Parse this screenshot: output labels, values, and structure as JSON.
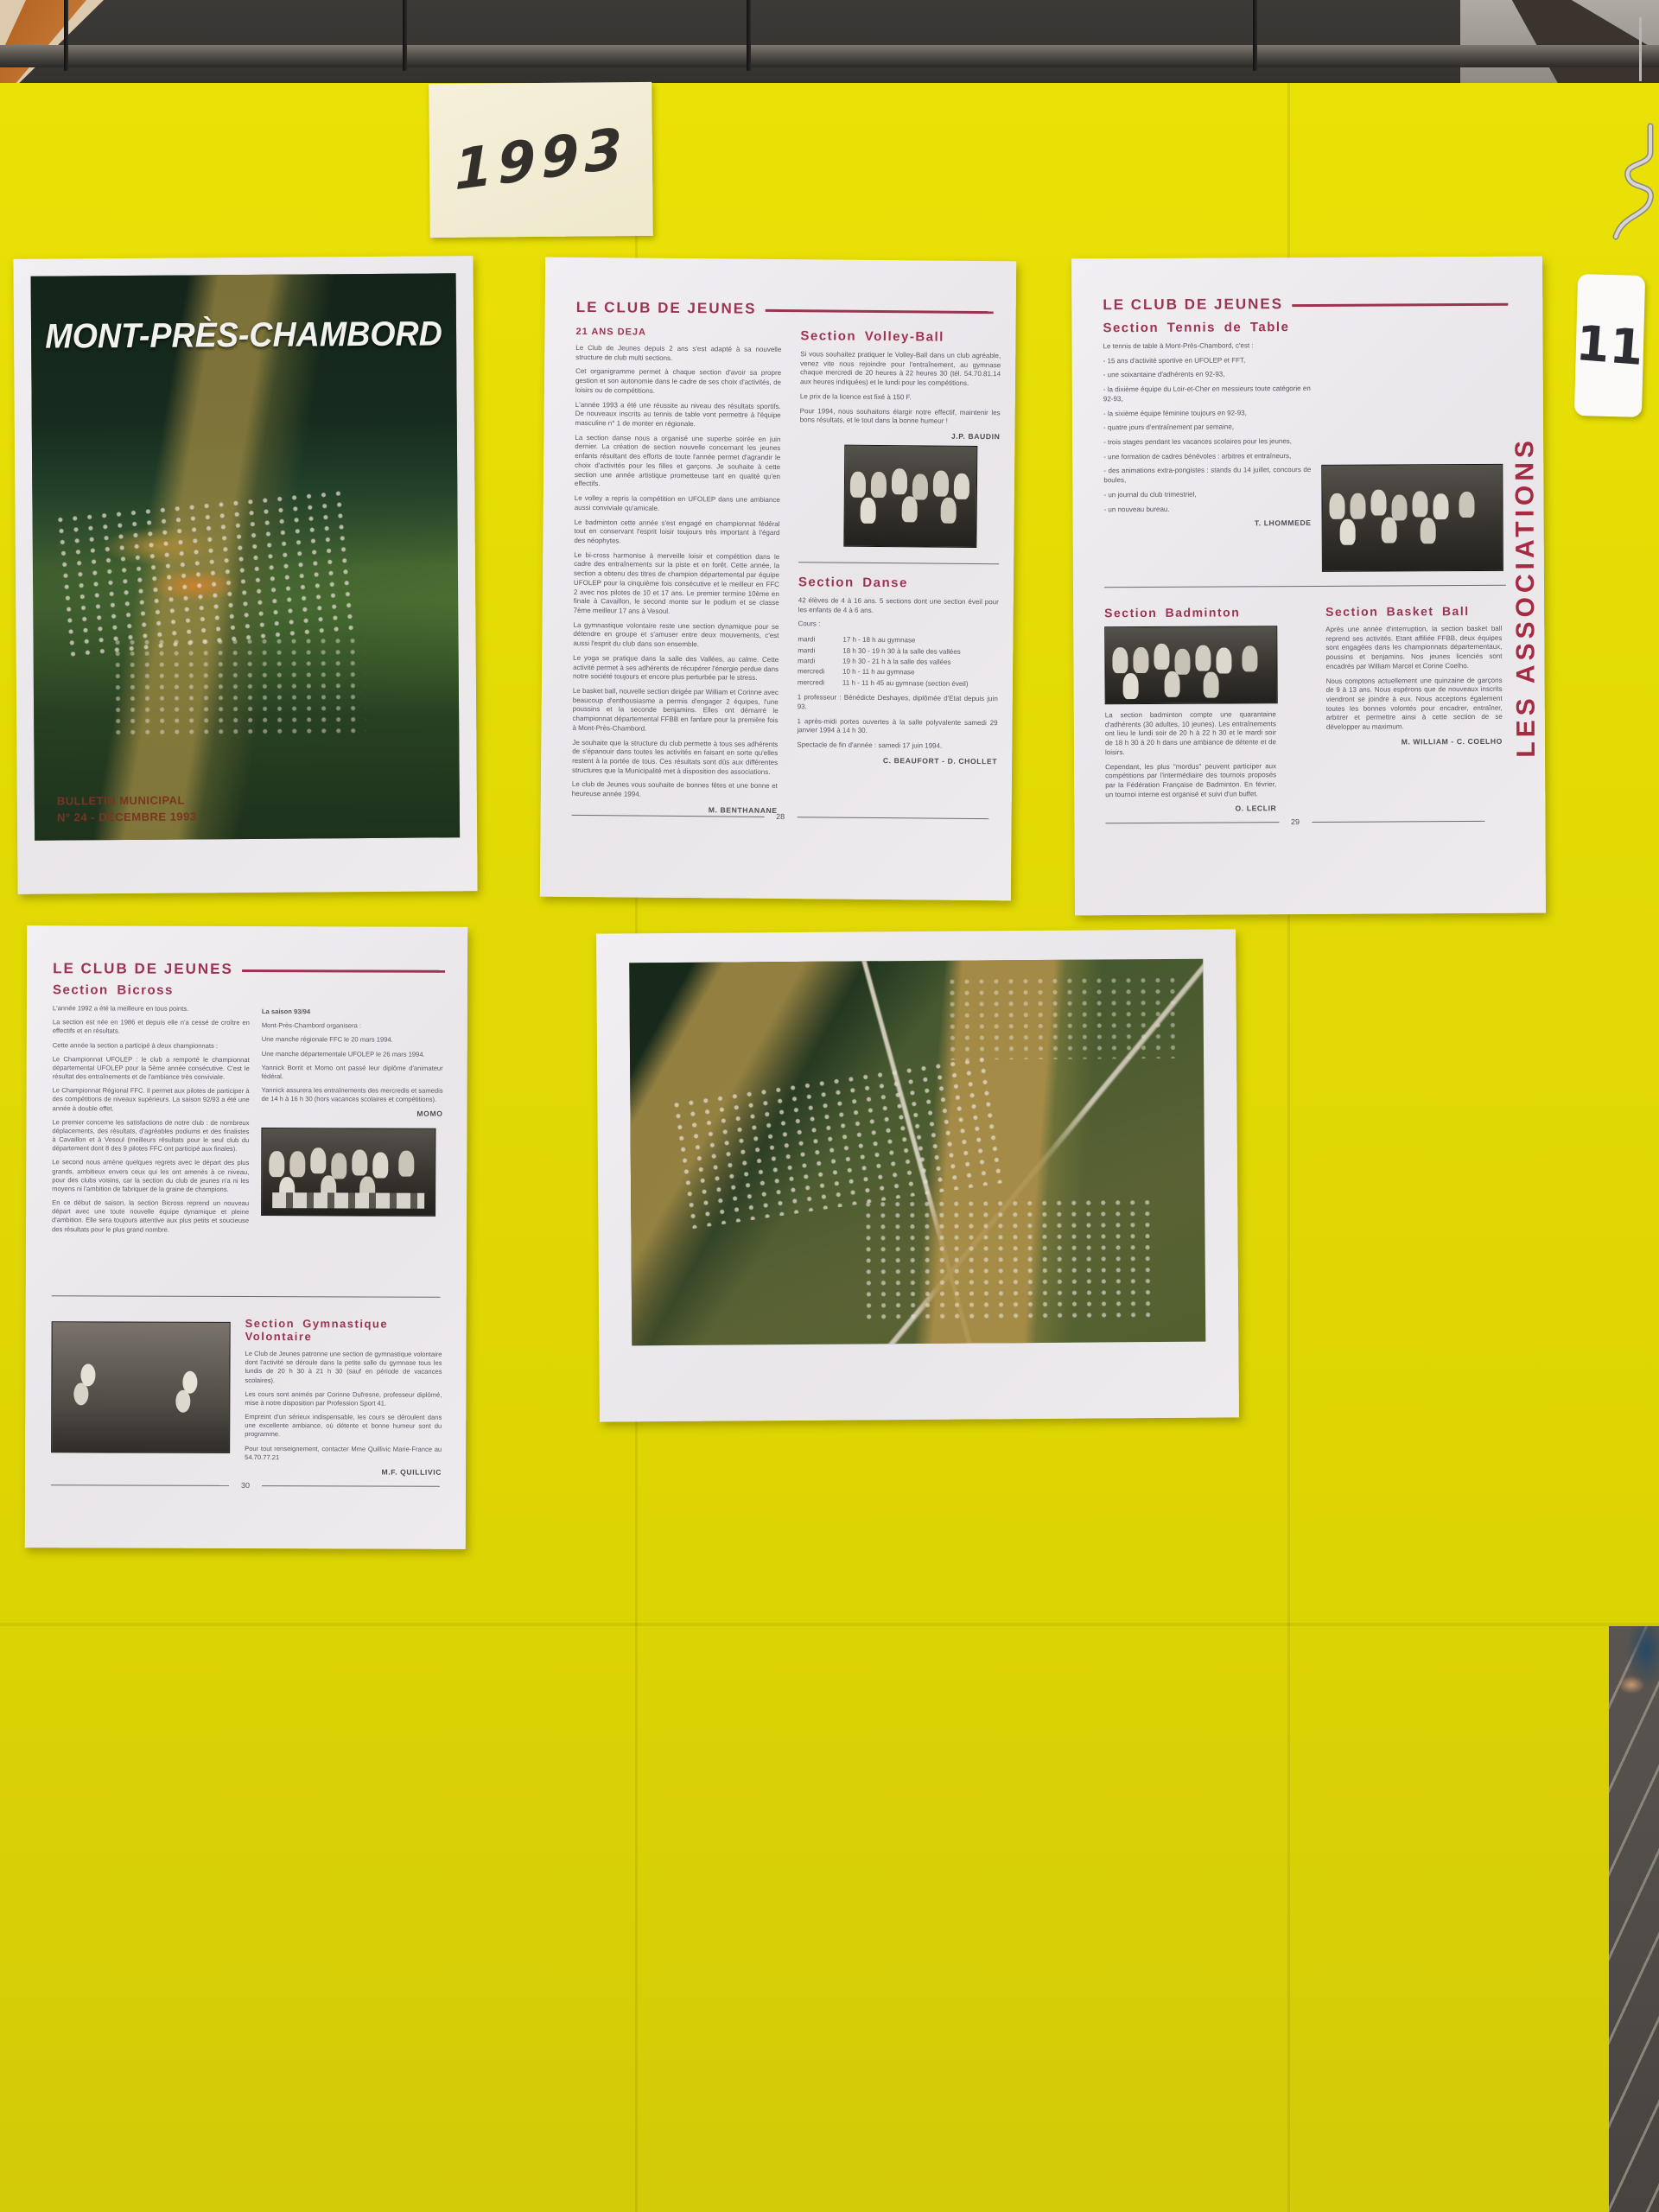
{
  "colors": {
    "board_yellow": "#e2d904",
    "paper_white": "#edeaee",
    "heading_red": "#9c3350",
    "sidebar_red": "#a52a42",
    "note_cream": "#f4eed6"
  },
  "board": {
    "note_year": "1993",
    "corner_label": "11"
  },
  "cover": {
    "title": "MONT-PRÈS-CHAMBORD",
    "caption_line1": "BULLETIN MUNICIPAL",
    "caption_line2": "N° 24 - DÉCEMBRE 1993"
  },
  "page28": {
    "header": "LE CLUB DE JEUNES",
    "intro_heading": "21 ANS DEJA",
    "intro_paragraphs": [
      "Le Club de Jeunes depuis 2 ans s'est adapté à sa nouvelle structure de club multi sections.",
      "Cet organigramme permet à chaque section d'avoir sa propre gestion et son autonomie dans le cadre de ses choix d'activités, de loisirs ou de compétitions.",
      "L'année 1993 a été une réussite au niveau des résultats sportifs. De nouveaux inscrits au tennis de table vont permettre à l'équipe masculine n° 1 de monter en régionale.",
      "La section danse nous a organisé une superbe soirée en juin dernier. La création de section nouvelle concernant les jeunes enfants résultant des efforts de toute l'année permet d'agrandir le choix d'activités pour les filles et garçons. Je souhaite à cette section une année artistique prometteuse tant en qualité qu'en effectifs.",
      "Le volley a repris la compétition en UFOLEP dans une ambiance aussi conviviale qu'amicale.",
      "Le badminton cette année s'est engagé en championnat fédéral tout en conservant l'esprit loisir toujours très important à l'égard des néophytes.",
      "Le bi-cross harmonise à merveille loisir et compétition dans le cadre des entraînements sur la piste et en forêt. Cette année, la section a obtenu des titres de champion départemental par équipe UFOLEP pour la cinquième fois consécutive et le meilleur en FFC 2 avec nos pilotes de 10 et 17 ans. Le premier termine 10ème en finale à Cavaillon, le second monte sur le podium et se classe 7ème meilleur 17 ans à Vesoul.",
      "La gymnastique volontaire reste une section dynamique pour se détendre en groupe et s'amuser entre deux mouvements, c'est aussi l'esprit du club dans son ensemble.",
      "Le yoga se pratique dans la salle des Vallées, au calme. Cette activité permet à ses adhérents de récupérer l'énergie perdue dans notre société toujours et encore plus perturbée par le stress.",
      "Le basket ball, nouvelle section dirigée par William et Corinne avec beaucoup d'enthousiasme a permis d'engager 2 équipes, l'une poussins et la seconde benjamins. Elles ont démarré le championnat départemental FFBB en fanfare pour la première fois à Mont-Près-Chambord.",
      "Je souhaite que la structure du club permette à tous ses adhérents de s'épanouir dans toutes les activités en faisant en sorte qu'elles restent à la portée de tous. Ces résultats sont dûs aux différentes structures que la Municipalité met à disposition des associations.",
      "Le club de Jeunes vous souhaite de bonnes fêtes et une bonne et heureuse année 1994."
    ],
    "intro_signature": "M. BENTHANANE",
    "volley": {
      "heading": "Section Volley-Ball",
      "paragraphs": [
        "Si vous souhaitez pratiquer le Volley-Ball dans un club agréable, venez vite nous rejoindre pour l'entraînement, au gymnase chaque mercredi de 20 heures à 22 heures 30 (tél. 54.70.81.14 aux heures indiquées) et le lundi pour les compétitions.",
        "Le prix de la licence est fixé à 150 F.",
        "Pour 1994, nous souhaitons élargir notre effectif, maintenir les bons résultats, et le tout dans la bonne humeur !"
      ],
      "signature": "J.P. BAUDIN"
    },
    "danse": {
      "heading": "Section Danse",
      "intro": "42 élèves de 4 à 16 ans. 5 sections dont une section éveil pour les enfants de 4 à 6 ans.",
      "cours_label": "Cours :",
      "schedule": [
        {
          "day": "mardi",
          "time": "17 h - 18 h au gymnase"
        },
        {
          "day": "mardi",
          "time": "18 h 30 - 19 h 30 à la salle des vallées"
        },
        {
          "day": "mardi",
          "time": "19 h 30 - 21 h à la salle des vallées"
        },
        {
          "day": "mercredi",
          "time": "10 h - 11 h au gymnase"
        },
        {
          "day": "mercredi",
          "time": "11 h - 11 h 45 au gymnase (section éveil)"
        }
      ],
      "notes": [
        "1 professeur : Bénédicte Deshayes, diplômée d'Etat depuis juin 93.",
        "1 après-midi portes ouvertes à la salle polyvalente samedi 29 janvier 1994 à 14 h 30.",
        "Spectacle de fin d'année : samedi 17 juin 1994."
      ],
      "signature": "C. BEAUFORT - D. CHOLLET"
    },
    "page_number": "28"
  },
  "page29": {
    "header": "LE CLUB DE JEUNES",
    "sidebar": "LES ASSOCIATIONS",
    "tennis": {
      "heading": "Section Tennis de Table",
      "intro": "Le tennis de table à Mont-Près-Chambord, c'est :",
      "bullets": [
        "- 15 ans d'activité sportive en UFOLEP et FFT,",
        "- une soixantaine d'adhérents en 92-93,",
        "- la dixième équipe du Loir-et-Cher en messieurs toute catégorie en 92-93,",
        "- la sixième équipe féminine toujours en 92-93,",
        "- quatre jours d'entraînement par semaine,",
        "- trois stages pendant les vacances scolaires pour les jeunes,",
        "- une formation de cadres bénévoles : arbitres et entraîneurs,",
        "- des animations extra-pongistes : stands du 14 juillet, concours de boules,",
        "- un journal du club trimestriel,",
        "- un nouveau bureau."
      ],
      "signature": "T. LHOMMEDE"
    },
    "badminton": {
      "heading": "Section Badminton",
      "paragraphs": [
        "La section badminton compte une quarantaine d'adhérents (30 adultes, 10 jeunes). Les entraînements ont lieu le lundi soir de 20 h à 22 h 30 et le mardi soir de 18 h 30 à 20 h dans une ambiance de détente et de loisirs.",
        "Cependant, les plus \"mordus\" peuvent participer aux compétitions par l'intermédiaire des tournois proposés par la Fédération Française de Badminton. En février, un tournoi interne est organisé et suivi d'un buffet."
      ],
      "signature": "O. LECLIR"
    },
    "basket": {
      "heading": "Section Basket Ball",
      "paragraphs": [
        "Après une année d'interruption, la section basket ball reprend ses activités. Etant affiliée FFBB, deux équipes sont engagées dans les championnats départementaux, poussins et benjamins. Nos jeunes licenciés sont encadrés par William Marcel et Corine Coelho.",
        "Nous comptons actuellement une quinzaine de garçons de 9 à 13 ans. Nous espérons que de nouveaux inscrits viendront se joindre à eux. Nous acceptons également toutes les bonnes volontés pour encadrer, entraîner, arbitrer et permettre ainsi à cette section de se développer au maximum."
      ],
      "signature": "M. WILLIAM - C. COELHO"
    },
    "page_number": "29"
  },
  "page30": {
    "header": "LE CLUB DE JEUNES",
    "bicross": {
      "heading": "Section Bicross",
      "left_paragraphs": [
        "L'année 1992 a été la meilleure en tous points.",
        "La section est née en 1986 et depuis elle n'a cessé de croître en effectifs et en résultats.",
        "Cette année la section a participé à deux championnats :",
        "Le Championnat UFOLEP : le club a remporté le championnat départemental UFOLEP pour la 5ème année consécutive. C'est le résultat des entraînements et de l'ambiance très conviviale.",
        "Le Championnat Régional FFC. Il permet aux pilotes de participer à des compétitions de niveaux supérieurs. La saison 92/93 a été une année à double effet.",
        "Le premier concerne les satisfactions de notre club : de nombreux déplacements, des résultats, d'agréables podiums et des finalistes à Cavaillon et à Vesoul (meilleurs résultats pour le seul club du département dont 8 des 9 pilotes FFC ont participé aux finales).",
        "Le second nous amène quelques regrets avec le départ des plus grands, ambitieux envers ceux qui les ont amenés à ce niveau, pour des clubs voisins, car la section du club de jeunes n'a ni les moyens ni l'ambition de fabriquer de la graine de champions.",
        "En ce début de saison, la section Bicross reprend un nouveau départ avec une toute nouvelle équipe dynamique et pleine d'ambition. Elle sera toujours attentive aux plus petits et soucieuse des résultats pour le plus grand nombre."
      ],
      "season_heading": "La saison 93/94",
      "season_paragraphs": [
        "Mont-Près-Chambord organisera :",
        "Une manche régionale FFC le 20 mars 1994.",
        "Une manche départementale UFOLEP le 26 mars 1994.",
        "Yannick Borrit et Momo ont passé leur diplôme d'animateur fédéral.",
        "Yannick assurera les entraînements des mercredis et samedis de 14 h à 16 h 30 (hors vacances scolaires et compétitions)."
      ],
      "season_signature": "MOMO"
    },
    "gym": {
      "heading": "Section Gymnastique Volontaire",
      "paragraphs": [
        "Le Club de Jeunes patronne une section de gymnastique volontaire dont l'activité se déroule dans la petite salle du gymnase tous les lundis de 20 h 30 à 21 h 30 (sauf en période de vacances scolaires).",
        "Les cours sont animés par Corinne Dufresne, professeur diplômé, mise à notre disposition par Profession Sport 41.",
        "Empreint d'un sérieux indispensable, les cours se déroulent dans une excellente ambiance, où détente et bonne humeur sont du programme.",
        "Pour tout renseignement, contacter Mme Quillivic Marie-France au 54.70.77.21"
      ],
      "signature": "M.F. QUILLIVIC"
    },
    "page_number": "30"
  }
}
